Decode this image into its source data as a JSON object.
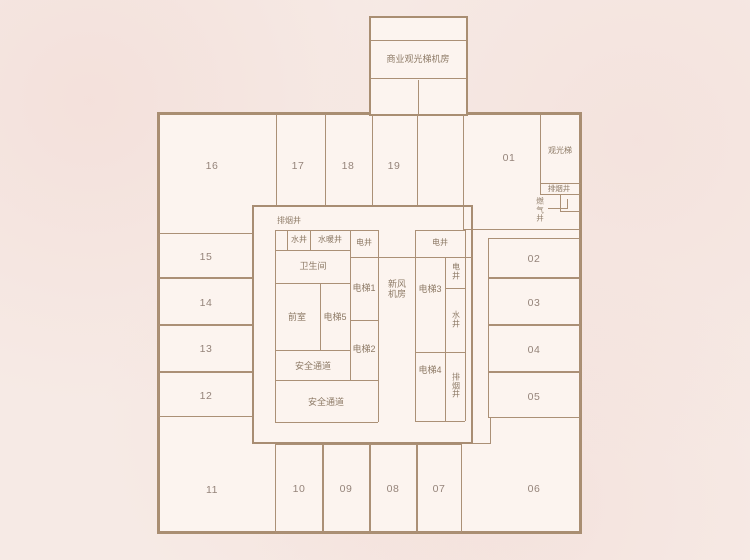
{
  "colors": {
    "page_background": "#f6eae5",
    "floor_fill": "#fcf4ef",
    "wall": "#ab9076",
    "label_text": "#8d7a66",
    "room_number_text": "#95847a"
  },
  "tower": {
    "machine_room": "商业观光梯机房"
  },
  "rooms": {
    "r01": "01",
    "r02": "02",
    "r03": "03",
    "r04": "04",
    "r05": "05",
    "r06": "06",
    "r07": "07",
    "r08": "08",
    "r09": "09",
    "r10": "10",
    "r11": "11",
    "r12": "12",
    "r13": "13",
    "r14": "14",
    "r15": "15",
    "r16": "16",
    "r17": "17",
    "r18": "18",
    "r19": "19"
  },
  "right_wing": {
    "sightseeing_elevator": "观光梯",
    "smoke_exhaust_shaft": "排烟井",
    "gas_shaft": "燃气井"
  },
  "core": {
    "smoke_exhaust_shaft": "排烟井",
    "water_shaft": "水井",
    "plumbing_shaft": "水暖井",
    "electric_shaft_top": "电井",
    "electric_shaft_right_top": "电井",
    "toilet": "卫生间",
    "elevator_1": "电梯1",
    "elevator_2": "电梯2",
    "elevator_3": "电梯3",
    "elevator_4": "电梯4",
    "elevator_5": "电梯5",
    "front_room": "前室",
    "fresh_air_room": "新风机房",
    "safety_passage_upper": "安全通道",
    "safety_passage_lower": "安全通道",
    "electric_shaft_vertical": "电井",
    "water_shaft_vertical": "水井",
    "smoke_exhaust_shaft_vertical": "排烟井"
  }
}
